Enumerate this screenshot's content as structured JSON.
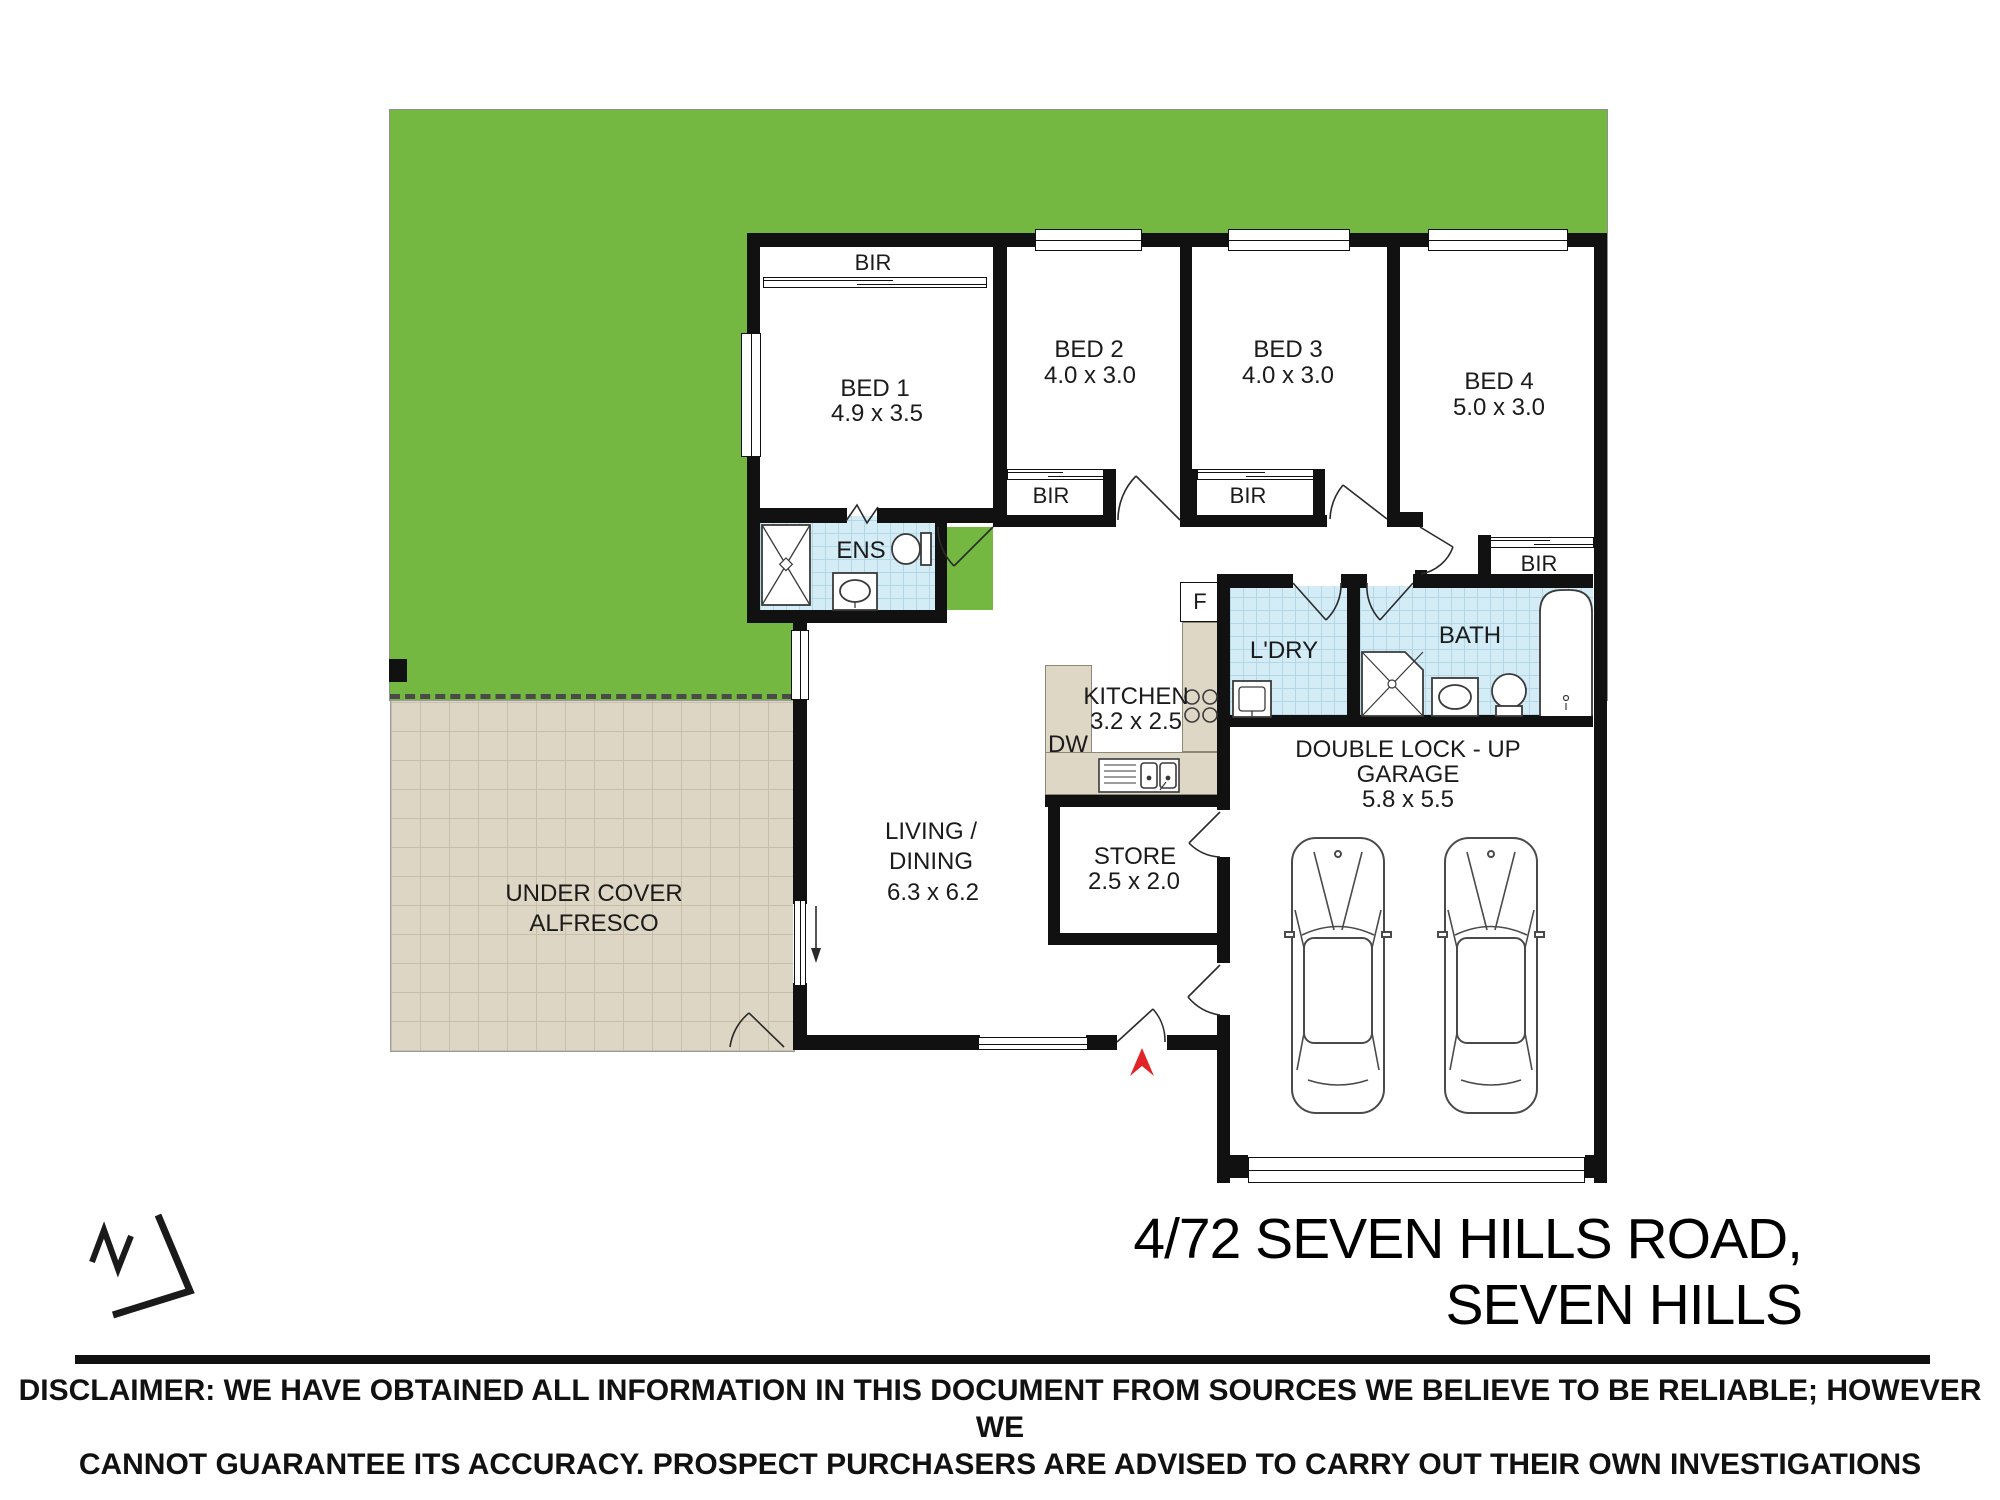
{
  "title": "Floor plan - 4/72 Seven Hills Road, Seven Hills",
  "rooms": {
    "bed1": {
      "name": "BED 1",
      "dims": "4.9 x 3.5"
    },
    "bed2": {
      "name": "BED 2",
      "dims": "4.0 x 3.0"
    },
    "bed3": {
      "name": "BED 3",
      "dims": "4.0 x 3.0"
    },
    "bed4": {
      "name": "BED 4",
      "dims": "5.0 x 3.0"
    },
    "ens": {
      "name": "ENS"
    },
    "bath": {
      "name": "BATH"
    },
    "ldry": {
      "name": "L'DRY"
    },
    "kitchen": {
      "name": "KITCHEN",
      "dims": "3.2 x 2.5"
    },
    "store": {
      "name": "STORE",
      "dims": "2.5 x 2.0"
    },
    "garage": {
      "line1": "DOUBLE LOCK - UP",
      "line2": "GARAGE",
      "dims": "5.8 x 5.5"
    },
    "living": {
      "line1": "LIVING /",
      "line2": "DINING",
      "dims": "6.3 x 6.2"
    },
    "alfresco": {
      "line1": "UNDER COVER",
      "line2": "ALFRESCO"
    }
  },
  "fixtures": {
    "bir": "BIR",
    "fridge": "F",
    "dishwasher": "DW"
  },
  "address": {
    "line1": "4/72 SEVEN HILLS ROAD,",
    "line2": "SEVEN HILLS"
  },
  "disclaimer": {
    "line1": "DISCLAIMER: WE HAVE OBTAINED ALL INFORMATION IN THIS DOCUMENT FROM SOURCES WE BELIEVE TO BE RELIABLE; HOWEVER WE",
    "line2": "CANNOT GUARANTEE ITS ACCURACY. PROSPECT PURCHASERS ARE ADVISED TO CARRY OUT THEIR OWN INVESTIGATIONS"
  },
  "colors": {
    "lawn": "#74b741",
    "tile": "#d3ecf6",
    "alfresco_paving": "#ddd6c4",
    "kitchen_bench": "#ded7c6",
    "wall": "#111111",
    "entry_arrow": "#e02428"
  }
}
